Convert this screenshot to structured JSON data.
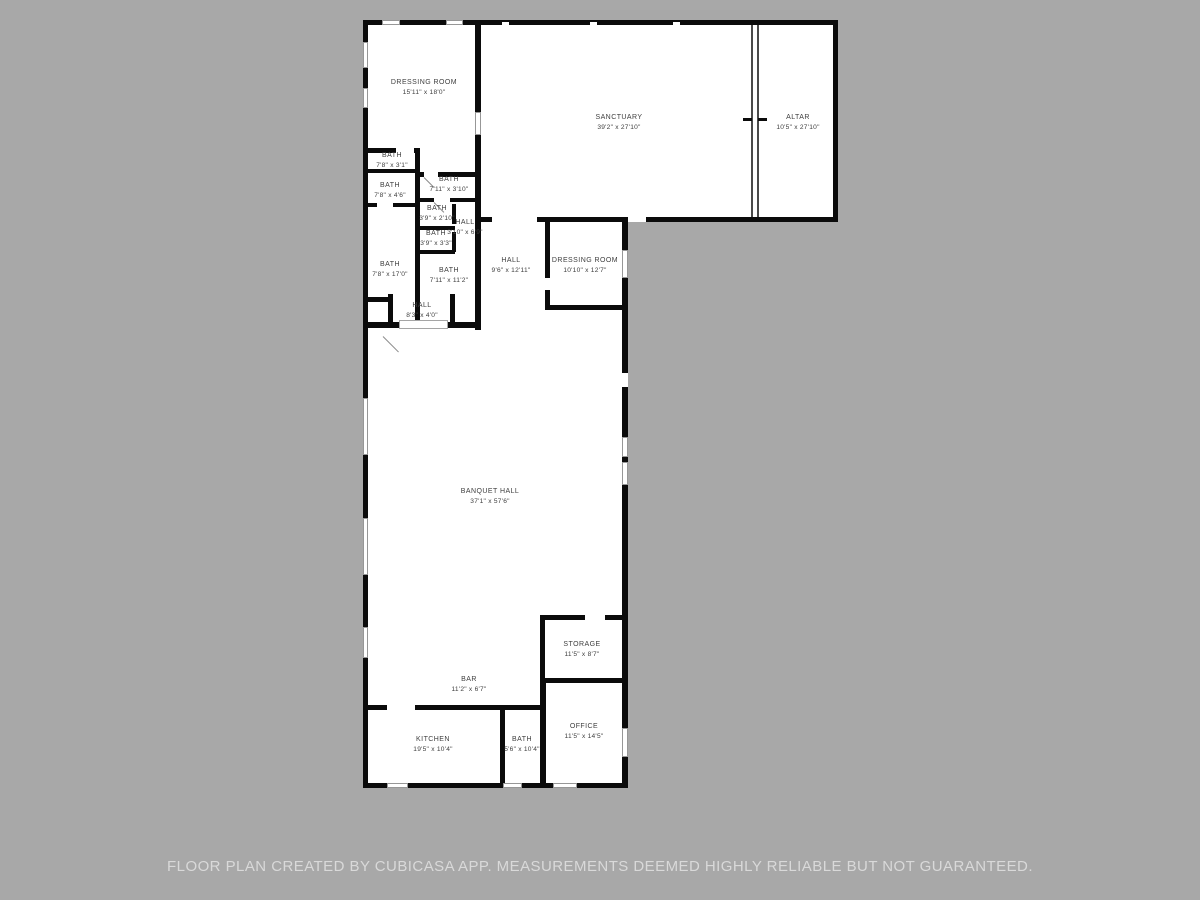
{
  "colors": {
    "page_background": "#a8a8a8",
    "floor_fill": "#ffffff",
    "wall_color": "#0b0b0b",
    "label_color": "#3e3e3e",
    "footer_text_color": "#d9d9d9"
  },
  "rooms": [
    {
      "name": "DRESSING ROOM",
      "dims": "15'11\" x 18'0\""
    },
    {
      "name": "SANCTUARY",
      "dims": "39'2\" x 27'10\""
    },
    {
      "name": "ALTAR",
      "dims": "10'5\" x 27'10\""
    },
    {
      "name": "BATH",
      "dims": "7'8\" x 3'1\""
    },
    {
      "name": "BATH",
      "dims": "7'8\" x 4'6\""
    },
    {
      "name": "BATH",
      "dims": "7'11\" x 3'10\""
    },
    {
      "name": "BATH",
      "dims": "3'9\" x 2'10\""
    },
    {
      "name": "HALL",
      "dims": "3'10\" x 6'9\""
    },
    {
      "name": "BATH",
      "dims": "3'9\" x 3'3\""
    },
    {
      "name": "BATH",
      "dims": "7'8\" x 17'0\""
    },
    {
      "name": "BATH",
      "dims": "7'11\" x 11'2\""
    },
    {
      "name": "HALL",
      "dims": "8'3\" x 4'0\""
    },
    {
      "name": "HALL",
      "dims": "9'6\" x 12'11\""
    },
    {
      "name": "DRESSING ROOM",
      "dims": "10'10\" x 12'7\""
    },
    {
      "name": "BANQUET HALL",
      "dims": "37'1\" x 57'6\""
    },
    {
      "name": "STORAGE",
      "dims": "11'5\" x 8'7\""
    },
    {
      "name": "BAR",
      "dims": "11'2\" x 6'7\""
    },
    {
      "name": "OFFICE",
      "dims": "11'5\" x 14'5\""
    },
    {
      "name": "KITCHEN",
      "dims": "19'5\" x 10'4\""
    },
    {
      "name": "BATH",
      "dims": "5'6\" x 10'4\""
    }
  ],
  "footer": {
    "text": "FLOOR PLAN CREATED BY CUBICASA APP. MEASUREMENTS DEEMED HIGHLY RELIABLE BUT NOT GUARANTEED."
  }
}
